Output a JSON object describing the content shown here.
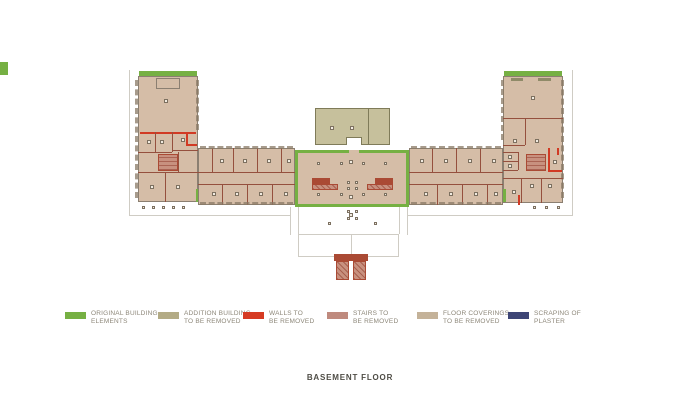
{
  "title": "BASEMENT FLOOR",
  "colors": {
    "green": "#76b043",
    "olive": "#c6c09c",
    "oliveBorder": "#7f7b59",
    "tan": "#d5bda7",
    "red": "#d13a24",
    "wall": "#95503e",
    "pink": "#c8917f",
    "pinkdark": "#aa4a34",
    "navy": "#3d4575",
    "outline": "#8b7f71",
    "faint": "#cfccc4",
    "columns": "#8a7a66",
    "chipbg": "#f1ebe1",
    "chipborder": "#7c7060",
    "textGray": "#8d8779",
    "titleColor": "#4e4c45"
  },
  "legend": {
    "items": [
      {
        "color": "#76b043",
        "line1": "ORIGINAL BUILDING",
        "line2": "ELEMENTS"
      },
      {
        "color": "#b3ab85",
        "line1": "ADDITION BUILDING",
        "line2": "TO BE REMOVED"
      },
      {
        "color": "#d63b23",
        "line1": "WALLS TO",
        "line2": "BE REMOVED"
      },
      {
        "color": "#bf8a7e",
        "line1": "STAIRS TO",
        "line2": "BE REMOVED"
      },
      {
        "color": "#c4b299",
        "line1": "FLOOR COVERINGS",
        "line2": "TO BE REMOVED"
      },
      {
        "color": "#3d4575",
        "line1": "SCRAPING OF",
        "line2": "PLASTER"
      }
    ]
  }
}
